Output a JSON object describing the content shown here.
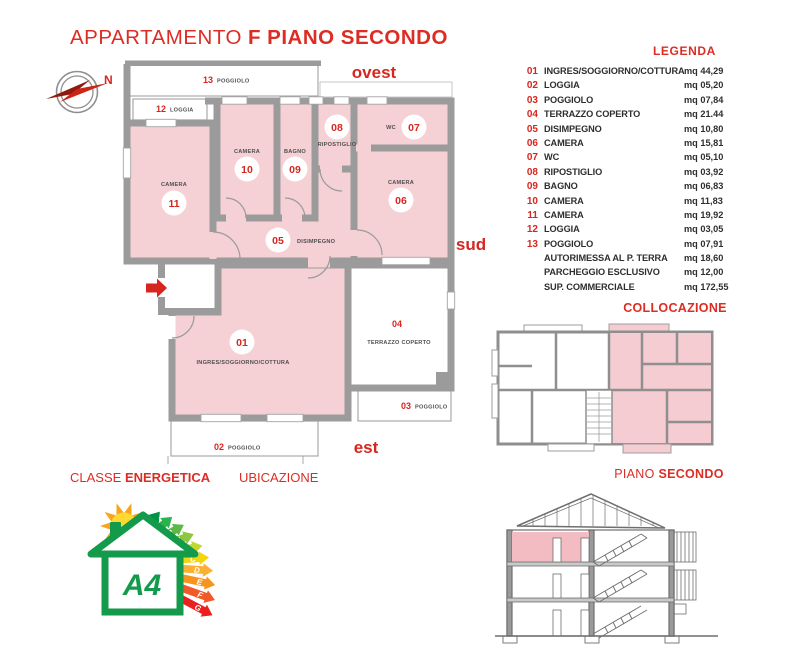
{
  "title": {
    "regular": "APPARTAMENTO",
    "bold": "F PIANO SECONDO"
  },
  "compass": {
    "north": "N"
  },
  "directions": {
    "west": "ovest",
    "south": "sud",
    "east": "est"
  },
  "plan": {
    "rooms": [
      {
        "num": "01",
        "label": "INGRES/SOGGIORNO/COTTURA"
      },
      {
        "num": "02",
        "label": "POGGIOLO"
      },
      {
        "num": "03",
        "label": "POGGIOLO"
      },
      {
        "num": "04",
        "label": "TERRAZZO COPERTO"
      },
      {
        "num": "05",
        "label": "DISIMPEGNO"
      },
      {
        "num": "06",
        "label": "CAMERA"
      },
      {
        "num": "07",
        "label": "WC"
      },
      {
        "num": "08",
        "label": "RIPOSTIGLIO"
      },
      {
        "num": "09",
        "label": "BAGNO"
      },
      {
        "num": "10",
        "label": "CAMERA"
      },
      {
        "num": "11",
        "label": "CAMERA"
      },
      {
        "num": "12",
        "label": "LOGGIA"
      },
      {
        "num": "13",
        "label": "POGGIOLO"
      }
    ]
  },
  "legend": {
    "title": "LEGENDA",
    "items": [
      {
        "num": "01",
        "label": "INGRES/SOGGIORNO/COTTURA",
        "area": "mq 44,29"
      },
      {
        "num": "02",
        "label": "LOGGIA",
        "area": "mq 05,20"
      },
      {
        "num": "03",
        "label": "POGGIOLO",
        "area": "mq 07,84"
      },
      {
        "num": "04",
        "label": "TERRAZZO COPERTO",
        "area": "mq 21.44"
      },
      {
        "num": "05",
        "label": "DISIMPEGNO",
        "area": "mq 10,80"
      },
      {
        "num": "06",
        "label": "CAMERA",
        "area": "mq 15,81"
      },
      {
        "num": "07",
        "label": "WC",
        "area": "mq 05,10"
      },
      {
        "num": "08",
        "label": "RIPOSTIGLIO",
        "area": "mq 03,92"
      },
      {
        "num": "09",
        "label": "BAGNO",
        "area": "mq 06,83"
      },
      {
        "num": "10",
        "label": "CAMERA",
        "area": "mq 11,83"
      },
      {
        "num": "11",
        "label": "CAMERA",
        "area": "mq 19,92"
      },
      {
        "num": "12",
        "label": "LOGGIA",
        "area": "mq 03,05"
      },
      {
        "num": "13",
        "label": "POGGIOLO",
        "area": "mq 07,91"
      },
      {
        "num": "",
        "label": "AUTORIMESSA AL P. TERRA",
        "area": "mq 18,60"
      },
      {
        "num": "",
        "label": "PARCHEGGIO ESCLUSIVO",
        "area": "mq 12,00"
      },
      {
        "num": "",
        "label": "SUP. COMMERCIALE",
        "area": "mq 172,55"
      }
    ]
  },
  "collocazione": {
    "title": "COLLOCAZIONE"
  },
  "piano": {
    "regular": "PIANO",
    "bold": "SECONDO"
  },
  "classe": {
    "regular": "CLASSE",
    "bold": "ENERGETICA"
  },
  "ubicazione": {
    "label": "UBICAZIONE"
  },
  "energy": {
    "class": "A4",
    "scale": [
      "A4",
      "A3",
      "A2",
      "A1",
      "B",
      "C",
      "D",
      "E",
      "F",
      "G"
    ],
    "colors": [
      "#009245",
      "#2bb24c",
      "#5cb947",
      "#8dc63f",
      "#c2d82e",
      "#f2d60b",
      "#fbb034",
      "#f7941e",
      "#f1592a",
      "#e9201f"
    ]
  }
}
